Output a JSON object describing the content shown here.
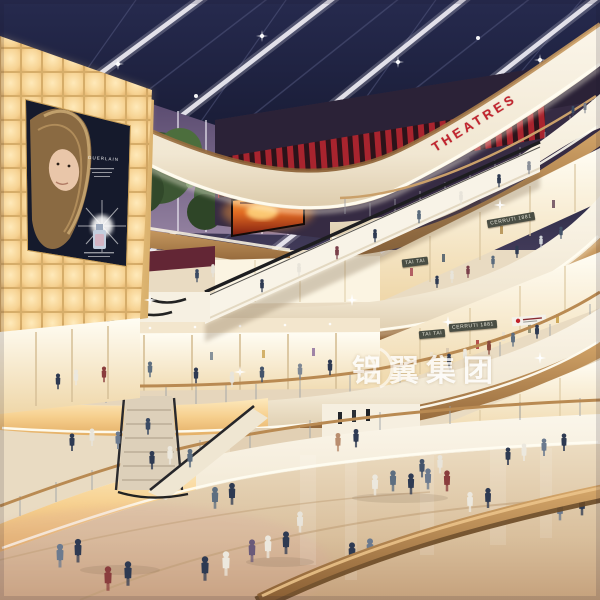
{
  "scene": {
    "description": "Multi-level shopping mall atrium interior, architectural rendering at dusk",
    "watermark": {
      "text": "铝翼集团"
    },
    "signs": {
      "theatre": "THEATRES",
      "store_blade_upper": "TAI TAI",
      "store_fascia_upper": "CERRUTI 1881",
      "store_blade_lower": "TAI TAI",
      "store_fascia_lower": "CERRUTI 1881",
      "billboard_brand": "GUERLAIN"
    },
    "palette": {
      "skylight_navy": "#1d2140",
      "beam_white": "#eceaf2",
      "fascia_cream": "#f6efe0",
      "wood_tan": "#b98950",
      "glow_panel_amber": "#f5d49a",
      "theatre_red": "#b2242d",
      "floor_beige": "#d9c3a3"
    }
  }
}
